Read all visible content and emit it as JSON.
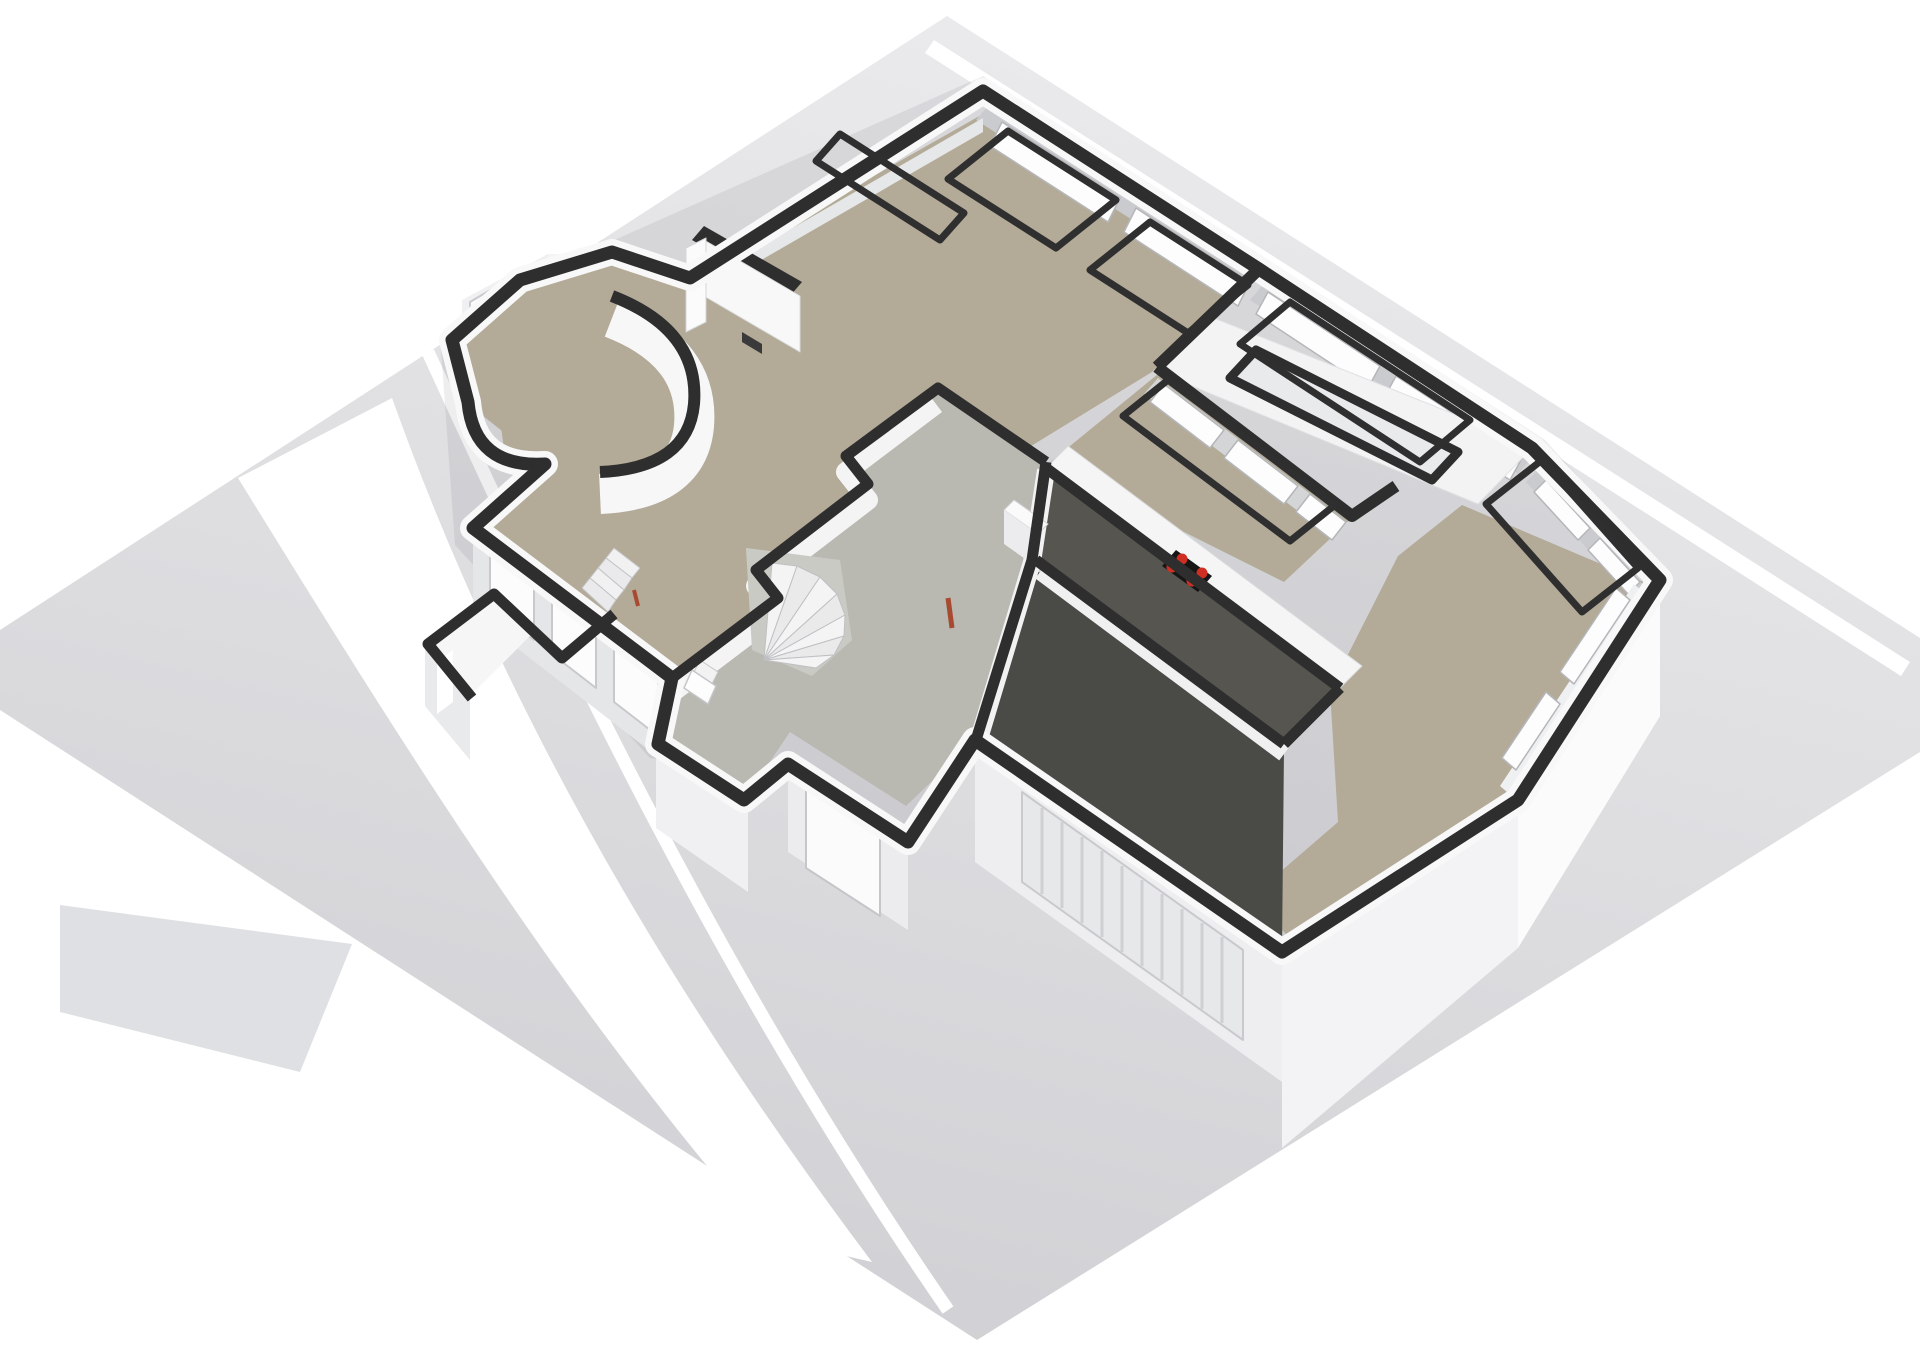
{
  "meta": {
    "description": "3D isometric floor plan rendering of a house ground floor on a light gray plot with white road stripes",
    "floor_shown": "ground floor",
    "rooms_visible": [
      "living-room",
      "kitchen",
      "sunroom",
      "dining-room",
      "hallway",
      "workroom",
      "garage",
      "wc",
      "entry-porch",
      "round-nook"
    ]
  },
  "palette": {
    "page_background": "#ffffff",
    "plot_gray_top": "#eaeaec",
    "plot_gray_bottom": "#d0d0d4",
    "road_white": "#ffffff",
    "wall_cut_dark": "#2e2e2f",
    "wall_white": "#f8f8f9",
    "wall_face_gray": "#c9cbce",
    "floor_beige": "#b3ab98",
    "floor_hall_gray": "#b9b8b1",
    "floor_dark_workroom": "#56554f",
    "floor_dark_garage": "#4a4a46",
    "counter_white": "#f5f5f6",
    "cooktop_black": "#161616",
    "burner_red": "#cf2f22",
    "door_accent_red": "#a84a30"
  },
  "scene": {
    "width": 1920,
    "height": 1358,
    "shapes": [
      {
        "n": "ground-plot",
        "t": "poly",
        "p": "947,16 1920,638 1920,752 977,1340 0,710 0,630",
        "f": "url(#gplane)"
      },
      {
        "n": "road-top-right",
        "t": "poly",
        "p": "934,40 1910,662 1901,676 925,53",
        "f": "#ffffff"
      },
      {
        "n": "road-band-left",
        "t": "path",
        "d": "M238,478 C400,740 560,1000 768,1238 L872,1262 C660,980 500,700 392,398 Z",
        "f": "#ffffff"
      },
      {
        "n": "road-stripe-narrow",
        "t": "path",
        "d": "M428,352 C560,640 720,980 948,1310",
        "s": "#ffffff",
        "w": 13
      },
      {
        "n": "ground-triangle",
        "t": "poly",
        "p": "60,905 352,944 300,1072 60,1012",
        "f": "#dfe0e3"
      },
      {
        "n": "house-shadow",
        "t": "poly",
        "p": "983,76 1545,440 1672,580 1524,814 1286,968 972,752 904,852 780,775 650,758 455,545 440,335 515,268 610,242",
        "f": "rgba(40,40,45,0.08)"
      },
      {
        "n": "dining-east-face",
        "t": "poly",
        "p": "1660,586 1518,804 1518,948 1660,716",
        "f": "#fbfbfc"
      },
      {
        "n": "dining-south-face",
        "t": "poly",
        "p": "1518,804 1282,956 1282,1148 1518,948",
        "f": "#f3f3f5"
      },
      {
        "n": "garage-front-face",
        "t": "poly",
        "p": "1282,956 975,744 975,862 1282,1082",
        "f": "#eeeef0"
      },
      {
        "n": "garage-roller-door",
        "t": "poly",
        "p": "1022,792 1243,950 1243,1040 1022,882",
        "f": "#e7e8ea",
        "s": "#c9cacd",
        "w": 2
      },
      {
        "n": "garage-door-slats",
        "t": "path",
        "d": "M1042,808 l0,86 M1062,822 l0,86 M1082,837 l0,86 M1102,851 l0,86 M1122,866 l0,86 M1142,880 l0,86 M1162,894 l0,86 M1182,909 l0,86 M1202,923 l0,86 M1222,937 l0,86",
        "s": "#cfd0d3",
        "w": 3
      },
      {
        "n": "lower-left-wall-face",
        "t": "poly",
        "p": "473,536 672,690 672,768 473,614",
        "f": "#e5e6e8"
      },
      {
        "n": "ll-window-1",
        "t": "poly",
        "p": "490,552 534,586 534,640 490,606",
        "f": "#fcfcfd",
        "s": "#c8c9cc",
        "w": 2
      },
      {
        "n": "ll-window-2",
        "t": "poly",
        "p": "552,600 596,634 596,688 552,654",
        "f": "#fcfcfd",
        "s": "#c8c9cc",
        "w": 2
      },
      {
        "n": "ll-window-3",
        "t": "poly",
        "p": "614,648 658,682 658,736 614,702",
        "f": "#fcfcfd",
        "s": "#c8c9cc",
        "w": 2
      },
      {
        "n": "porch-front-face",
        "t": "poly",
        "p": "656,748 748,812 748,892 656,828",
        "f": "#f0f0f2"
      },
      {
        "n": "entry-door-wall-face",
        "t": "poly",
        "p": "788,764 908,842 908,930 788,852",
        "f": "#ececee"
      },
      {
        "n": "entry-door",
        "t": "poly",
        "p": "806,788 880,836 880,916 806,868",
        "f": "#fbfbfc",
        "s": "#c5c6c9",
        "w": 2
      },
      {
        "n": "wc-block-top",
        "t": "poly",
        "p": "425,642 492,592 538,628 470,696",
        "f": "#f6f6f7"
      },
      {
        "n": "wc-block-face",
        "t": "poly",
        "p": "425,642 470,696 470,760 425,706",
        "f": "#e9eaec"
      },
      {
        "n": "wc-window",
        "t": "poly",
        "p": "437,662 453,650 453,702 437,714",
        "f": "#ffffff"
      },
      {
        "n": "bay-face-left",
        "t": "poly",
        "p": "462,300 548,254 548,318 462,364",
        "f": "#eef0f1"
      },
      {
        "n": "bay-window-left",
        "t": "poly",
        "p": "470,302 538,262 538,314 470,354",
        "f": "#fcfcfd",
        "s": "#c8c9cc",
        "w": 2
      },
      {
        "n": "bay-face-top",
        "t": "poly",
        "p": "548,254 612,254 612,302 548,302",
        "f": "#f4f4f5"
      },
      {
        "n": "bay-window-top",
        "t": "poly",
        "p": "554,260 606,260 606,296 554,298",
        "f": "#fdfdfe",
        "s": "#c8c9cc",
        "w": 2
      },
      {
        "n": "floor-living-room",
        "t": "poly",
        "p": "983,114 1240,281 1152,372 1005,462 936,390 846,458 868,486 756,572 778,598 670,680 480,532 545,465 468,404 452,342 520,282 612,254 690,280",
        "f": "#b3ab98"
      },
      {
        "n": "floor-kitchen",
        "t": "poly",
        "p": "1158,374 1350,520 1284,582 1048,464",
        "f": "#b3ab98"
      },
      {
        "n": "floor-round-nook",
        "t": "poly",
        "p": "500,420 560,390 630,400 660,432 640,466 560,478 505,456",
        "f": "#b3ab98"
      },
      {
        "n": "floor-dining-room",
        "t": "poly",
        "p": "1462,505 1648,584 1506,794 1290,938 1250,898 1338,822 1330,690 1398,556",
        "f": "#b3ab98"
      },
      {
        "n": "floor-hallway",
        "t": "poly",
        "p": "670,680 778,598 756,572 868,486 846,458 936,390 1046,462 1032,560 975,740 906,806 790,732 744,800 658,746",
        "f": "#b9b8b1"
      },
      {
        "n": "floor-workroom",
        "t": "poly",
        "p": "1050,470 1340,688 1284,742 1032,562",
        "f": "#56554f"
      },
      {
        "n": "floor-garage",
        "t": "poly",
        "p": "1036,570 1284,748 1282,950 976,742",
        "f": "#4a4a46"
      },
      {
        "n": "hall-wall-faces",
        "t": "path",
        "d": "M670,694 L778,612 L756,586 L868,500 L846,472 L936,404",
        "s": "#f4f4f5",
        "w": 20
      },
      {
        "n": "utility-west-wall-face",
        "t": "path",
        "d": "M1046,470 L1032,562 L978,742",
        "s": "#f2f2f3",
        "w": 18
      },
      {
        "n": "divider-wall-face",
        "t": "path",
        "d": "M1040,572 L1284,754",
        "s": "#f0f0f1",
        "w": 16
      },
      {
        "n": "top-right-wall-inner-face",
        "t": "poly",
        "p": "988,106 1254,276 1242,290 976,120",
        "f": "#c9cbce"
      },
      {
        "n": "tr-window-pane-1",
        "t": "poly",
        "p": "1002,122 1120,198 1108,222 990,146",
        "f": "#fdfdfe",
        "s": "#b5b6b9",
        "w": 1.5
      },
      {
        "n": "tr-window-pane-2",
        "t": "poly",
        "p": "1136,208 1250,282 1238,306 1124,232",
        "f": "#fdfdfe",
        "s": "#b5b6b9",
        "w": 1.5
      },
      {
        "n": "tr-ext-wall-inner-face",
        "t": "poly",
        "p": "1262,286 1530,460 1518,474 1250,300",
        "f": "#c9cbce"
      },
      {
        "n": "tr-ext-pane-1",
        "t": "poly",
        "p": "1268,292 1380,366 1368,388 1256,314",
        "f": "#fdfdfe",
        "s": "#b5b6b9",
        "w": 1.5
      },
      {
        "n": "tr-ext-pane-2",
        "t": "poly",
        "p": "1396,376 1522,458 1510,480 1384,398",
        "f": "#fdfdfe",
        "s": "#b5b6b9",
        "w": 1.5
      },
      {
        "n": "top-left-wall-inner-face",
        "t": "poly",
        "p": "692,286 983,118 983,132 692,300",
        "f": "#e6e7e9"
      },
      {
        "n": "sunroom-glass-band",
        "t": "poly",
        "p": "1158,378 1350,524 1336,540 1144,394",
        "f": "#d3d5d7"
      },
      {
        "n": "sunroom-pane-1",
        "t": "poly",
        "p": "1164,384 1224,430 1210,448 1150,402",
        "f": "#fdfdfe",
        "s": "#b5b6b9",
        "w": 1.5
      },
      {
        "n": "sunroom-pane-2",
        "t": "poly",
        "p": "1238,440 1298,486 1284,504 1224,458",
        "f": "#fdfdfe",
        "s": "#b5b6b9",
        "w": 1.5
      },
      {
        "n": "sunroom-pane-3",
        "t": "poly",
        "p": "1310,494 1346,522 1332,540 1296,512",
        "f": "#fdfdfe",
        "s": "#b5b6b9",
        "w": 1.5
      },
      {
        "n": "dining-ne-wall-face",
        "t": "poly",
        "p": "1538,470 1648,590 1636,602 1526,482",
        "f": "#c9cbce"
      },
      {
        "n": "dining-ne-pane-1",
        "t": "poly",
        "p": "1546,480 1590,528 1578,540 1534,492",
        "f": "#fdfdfe",
        "s": "#b5b6b9",
        "w": 1.5
      },
      {
        "n": "dining-ne-pane-2",
        "t": "poly",
        "p": "1600,538 1640,582 1628,594 1588,550",
        "f": "#fdfdfe",
        "s": "#b5b6b9",
        "w": 1.5
      },
      {
        "n": "dining-se-wall-face",
        "t": "poly",
        "p": "1648,596 1514,798 1500,786 1634,584",
        "f": "#eff0f2"
      },
      {
        "n": "dining-se-pane-1",
        "t": "poly",
        "p": "1630,600 1574,684 1560,672 1616,588",
        "f": "#fdfdfe",
        "s": "#b5b6b9",
        "w": 1.5
      },
      {
        "n": "dining-se-pane-2",
        "t": "poly",
        "p": "1560,704 1516,770 1502,758 1546,692",
        "f": "#fdfdfe",
        "s": "#b5b6b9",
        "w": 1.5
      },
      {
        "n": "kitchen-counter",
        "t": "poly",
        "p": "1046,468 1340,688 1362,666 1068,446",
        "f": "#f5f5f6",
        "s": "#d8d9db",
        "w": 1
      },
      {
        "n": "cooktop",
        "t": "poly",
        "p": "1176,550 1212,576 1198,592 1162,566",
        "f": "#161616"
      },
      {
        "n": "burner-1",
        "t": "circle",
        "cx": 1182,
        "cy": 559,
        "r": 5.5,
        "f": "#cf2f22"
      },
      {
        "n": "burner-2",
        "t": "circle",
        "cx": 1202,
        "cy": 573,
        "r": 5.5,
        "f": "#cf2f22"
      },
      {
        "n": "burner-3",
        "t": "circle",
        "cx": 1172,
        "cy": 567,
        "r": 5.5,
        "f": "#cf2f22"
      },
      {
        "n": "burner-4",
        "t": "circle",
        "cx": 1192,
        "cy": 581,
        "r": 5.5,
        "f": "#cf2f22"
      },
      {
        "n": "boiler-top",
        "t": "poly",
        "p": "1014,500 1048,524 1038,534 1004,510",
        "f": "#fafafa",
        "s": "#d0d1d4",
        "w": 1
      },
      {
        "n": "boiler-face",
        "t": "poly",
        "p": "1004,510 1038,534 1038,568 1004,544",
        "f": "#ececee"
      },
      {
        "n": "fireplace-cap",
        "t": "poly",
        "p": "704,226 802,282 790,296 692,240",
        "f": "#2e2e2f"
      },
      {
        "n": "fireplace-panel",
        "t": "poly",
        "p": "704,240 800,296 800,352 704,296",
        "f": "#f8f8f9",
        "s": "#dadbdd",
        "w": 1
      },
      {
        "n": "fireplace-column",
        "t": "poly",
        "p": "686,248 706,238 706,322 686,332",
        "f": "#fbfbfc",
        "s": "#d5d6d8",
        "w": 1
      },
      {
        "n": "fireplace-vent",
        "t": "poly",
        "p": "742,332 762,344 762,354 742,342",
        "f": "#3a3a3a"
      },
      {
        "n": "toilet-tank",
        "t": "poly",
        "p": "700,660 718,672 712,684 694,672",
        "f": "#f2f2f3",
        "s": "#c5c6c9",
        "w": 1
      },
      {
        "n": "toilet-bowl",
        "t": "poly",
        "p": "692,670 716,686 708,704 684,688",
        "f": "#fdfdfd",
        "s": "#c5c6c9",
        "w": 1.5
      },
      {
        "n": "stairs-base",
        "t": "poly",
        "p": "746,548 840,560 852,640 812,676 752,650",
        "f": "#cacac5"
      },
      {
        "n": "stair-tread-1",
        "t": "poly",
        "p": "764,660 772,563 797,566",
        "f": "#f4f4f5",
        "s": "#bfc0c3",
        "w": 1
      },
      {
        "n": "stair-tread-2",
        "t": "poly",
        "p": "764,660 797,566 820,577",
        "f": "#eaeaeb",
        "s": "#bfc0c3",
        "w": 1
      },
      {
        "n": "stair-tread-3",
        "t": "poly",
        "p": "764,660 820,577 837,594",
        "f": "#f4f4f5",
        "s": "#bfc0c3",
        "w": 1
      },
      {
        "n": "stair-tread-4",
        "t": "poly",
        "p": "764,660 837,594 845,615",
        "f": "#eaeaeb",
        "s": "#bfc0c3",
        "w": 1
      },
      {
        "n": "stair-tread-5",
        "t": "poly",
        "p": "764,660 845,615 844,636",
        "f": "#f4f4f5",
        "s": "#bfc0c3",
        "w": 1
      },
      {
        "n": "stair-tread-6",
        "t": "poly",
        "p": "764,660 844,636 834,655",
        "f": "#eaeaeb",
        "s": "#bfc0c3",
        "w": 1
      },
      {
        "n": "stair-tread-7",
        "t": "poly",
        "p": "764,660 834,655 816,668",
        "f": "#f4f4f5",
        "s": "#bfc0c3",
        "w": 1
      },
      {
        "n": "ministair-1",
        "t": "poly",
        "p": "614,548 640,568 632,578 606,558",
        "f": "#f1f1f2",
        "s": "#c2c3c6",
        "w": 1
      },
      {
        "n": "ministair-2",
        "t": "poly",
        "p": "606,558 632,578 624,590 598,568",
        "f": "#eaeaec",
        "s": "#c2c3c6",
        "w": 1
      },
      {
        "n": "ministair-3",
        "t": "poly",
        "p": "598,568 624,590 616,600 590,578",
        "f": "#f1f1f2",
        "s": "#c2c3c6",
        "w": 1
      },
      {
        "n": "ministair-4",
        "t": "poly",
        "p": "590,578 616,600 608,612 582,588",
        "f": "#eaeaec",
        "s": "#c2c3c6",
        "w": 1
      },
      {
        "n": "door-accent-1",
        "t": "line",
        "x1": 948,
        "y1": 598,
        "x2": 952,
        "y2": 628,
        "s": "#a84a30",
        "w": 5
      },
      {
        "n": "door-accent-2",
        "t": "line",
        "x1": 634,
        "y1": 590,
        "x2": 638,
        "y2": 606,
        "s": "#a84a30",
        "w": 4
      },
      {
        "n": "sunroom-roof",
        "t": "poly",
        "p": "1214,318 1534,446 1478,504 1158,372",
        "f": "#f3f3f4",
        "s": "#e0e1e3",
        "w": 1
      },
      {
        "n": "sunroom-skylight",
        "t": "poly",
        "p": "1256,350 1458,452 1432,480 1230,378",
        "f": "#e9eaec",
        "s": "#2e2e2f",
        "w": 9
      },
      {
        "n": "wall-ring-white-edge",
        "t": "path",
        "d": "M983,91 L1259,269 L1532,448 L1660,580 L1518,800 L1282,952 L975,740 L908,842 L788,764 L744,800 L658,744 L672,678 L473,528 L545,464 Q474,468 468,402 L452,340 L520,280 L612,252 L690,278 Z",
        "s": "#f8f8f9",
        "w": 26
      },
      {
        "n": "wall-ring-dark-top",
        "t": "path",
        "d": "M983,91 L1259,269 L1532,448 L1660,580 L1518,800 L1282,952 L975,740 L908,842 L788,764 L744,800 L658,744 L672,678 L473,528 L545,464 Q474,468 468,402 L452,340 L520,280 L612,252 L690,278 Z",
        "s": "#2e2e2f",
        "w": 13
      },
      {
        "n": "wall-hall-living",
        "t": "path",
        "d": "M672,678 L778,598 L756,570 L868,484 L846,456 L938,388 L1046,462",
        "s": "#2e2e2f",
        "w": 11
      },
      {
        "n": "wall-utility-west",
        "t": "path",
        "d": "M1046,462 L1032,560 L976,740",
        "s": "#2e2e2f",
        "w": 11
      },
      {
        "n": "wall-counter",
        "t": "path",
        "d": "M1046,468 L1340,688",
        "s": "#2e2e2f",
        "w": 11
      },
      {
        "n": "wall-divider",
        "t": "path",
        "d": "M1036,560 L1284,744",
        "s": "#2e2e2f",
        "w": 11
      },
      {
        "n": "wall-workroom-east",
        "t": "path",
        "d": "M1340,688 L1284,744",
        "s": "#2e2e2f",
        "w": 11
      },
      {
        "n": "wall-sunroom-left",
        "t": "path",
        "d": "M1259,269 L1157,367",
        "s": "#2e2e2f",
        "w": 12
      },
      {
        "n": "wall-sunroom-glass",
        "t": "path",
        "d": "M1157,367 L1352,516 L1396,486",
        "s": "#2e2e2f",
        "w": 12
      },
      {
        "n": "wall-wc",
        "t": "path",
        "d": "M614,614 L562,658 L494,594 L428,644 L472,698",
        "s": "#2e2e2f",
        "w": 11
      },
      {
        "n": "curved-wall-face",
        "t": "path",
        "d": "M612,318 Q700,352 694,426 Q688,490 600,494",
        "s": "#f7f7f8",
        "w": 40
      },
      {
        "n": "curved-wall-top",
        "t": "path",
        "d": "M612,296 Q700,330 694,404 Q688,468 600,472",
        "s": "#2e2e2f",
        "w": 12
      },
      {
        "n": "window-frame-top-left",
        "t": "poly",
        "p": "840,134 964,213 940,240 816,161",
        "s": "#2f2f30",
        "w": 7
      },
      {
        "n": "window-frame-tr-1",
        "t": "poly",
        "p": "1008,131 1116,200 1056,248 948,179",
        "s": "#2f2f30",
        "w": 7
      },
      {
        "n": "window-frame-tr-2",
        "t": "poly",
        "p": "1150,222 1248,285 1188,333 1090,270",
        "s": "#2f2f30",
        "w": 7
      },
      {
        "n": "window-frame-kitchen",
        "t": "poly",
        "p": "1168,380 1335,505 1290,541 1123,416",
        "s": "#2f2f30",
        "w": 7
      },
      {
        "n": "window-frame-sunroom",
        "t": "poly",
        "p": "1290,302 1470,420 1420,462 1240,344",
        "s": "#2f2f30",
        "w": 7
      },
      {
        "n": "window-frame-dining",
        "t": "poly",
        "p": "1542,460 1638,568 1582,612 1486,504",
        "s": "#2f2f30",
        "w": 7
      }
    ]
  }
}
